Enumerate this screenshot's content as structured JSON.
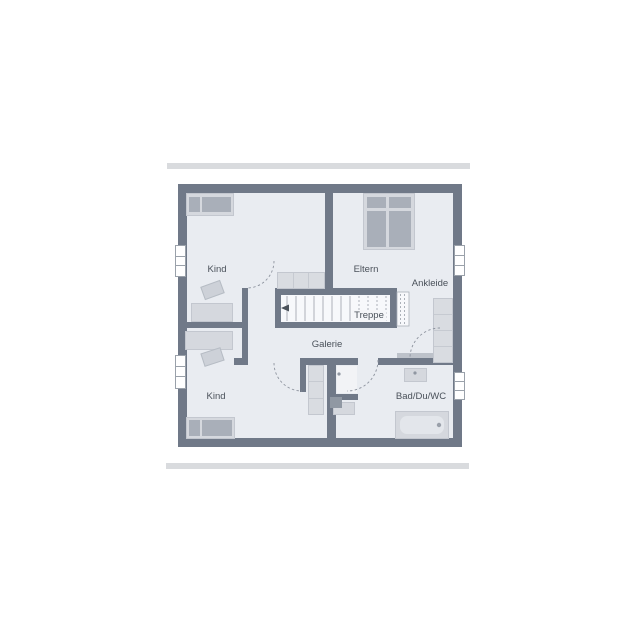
{
  "plan": {
    "type": "floor-plan",
    "rooms": {
      "kind_top": {
        "label": "Kind"
      },
      "eltern": {
        "label": "Eltern"
      },
      "ankleide": {
        "label": "Ankleide"
      },
      "galerie": {
        "label": "Galerie"
      },
      "kind_bottom": {
        "label": "Kind"
      },
      "bad": {
        "label": "Bad/Du/WC"
      }
    },
    "stairs": {
      "label": "Treppe",
      "direction_arrow": "left",
      "treads_solid": 8,
      "treads_dashed": 6
    },
    "furniture": {
      "kind_top": [
        "bed",
        "desk",
        "dresser",
        "sideboard"
      ],
      "eltern": [
        "double-bed"
      ],
      "ankleide": [
        "wardrobe"
      ],
      "kind_bottom": [
        "dresser",
        "desk",
        "bed",
        "cabinet"
      ],
      "bad": [
        "washbasin",
        "shower",
        "wc",
        "bathtub"
      ]
    },
    "windows": {
      "left_wall": 2,
      "right_wall": 2
    },
    "door_arcs": 4,
    "colors": {
      "wall": "#707988",
      "floor": "#e9ecf1",
      "furniture_light": "#d5d8de",
      "furniture_dark": "#a9afb9",
      "stair_floor": "#f7f8fb",
      "divider_bar": "#d9dbde",
      "label_text": "#4a515a",
      "background": "#ffffff"
    }
  }
}
